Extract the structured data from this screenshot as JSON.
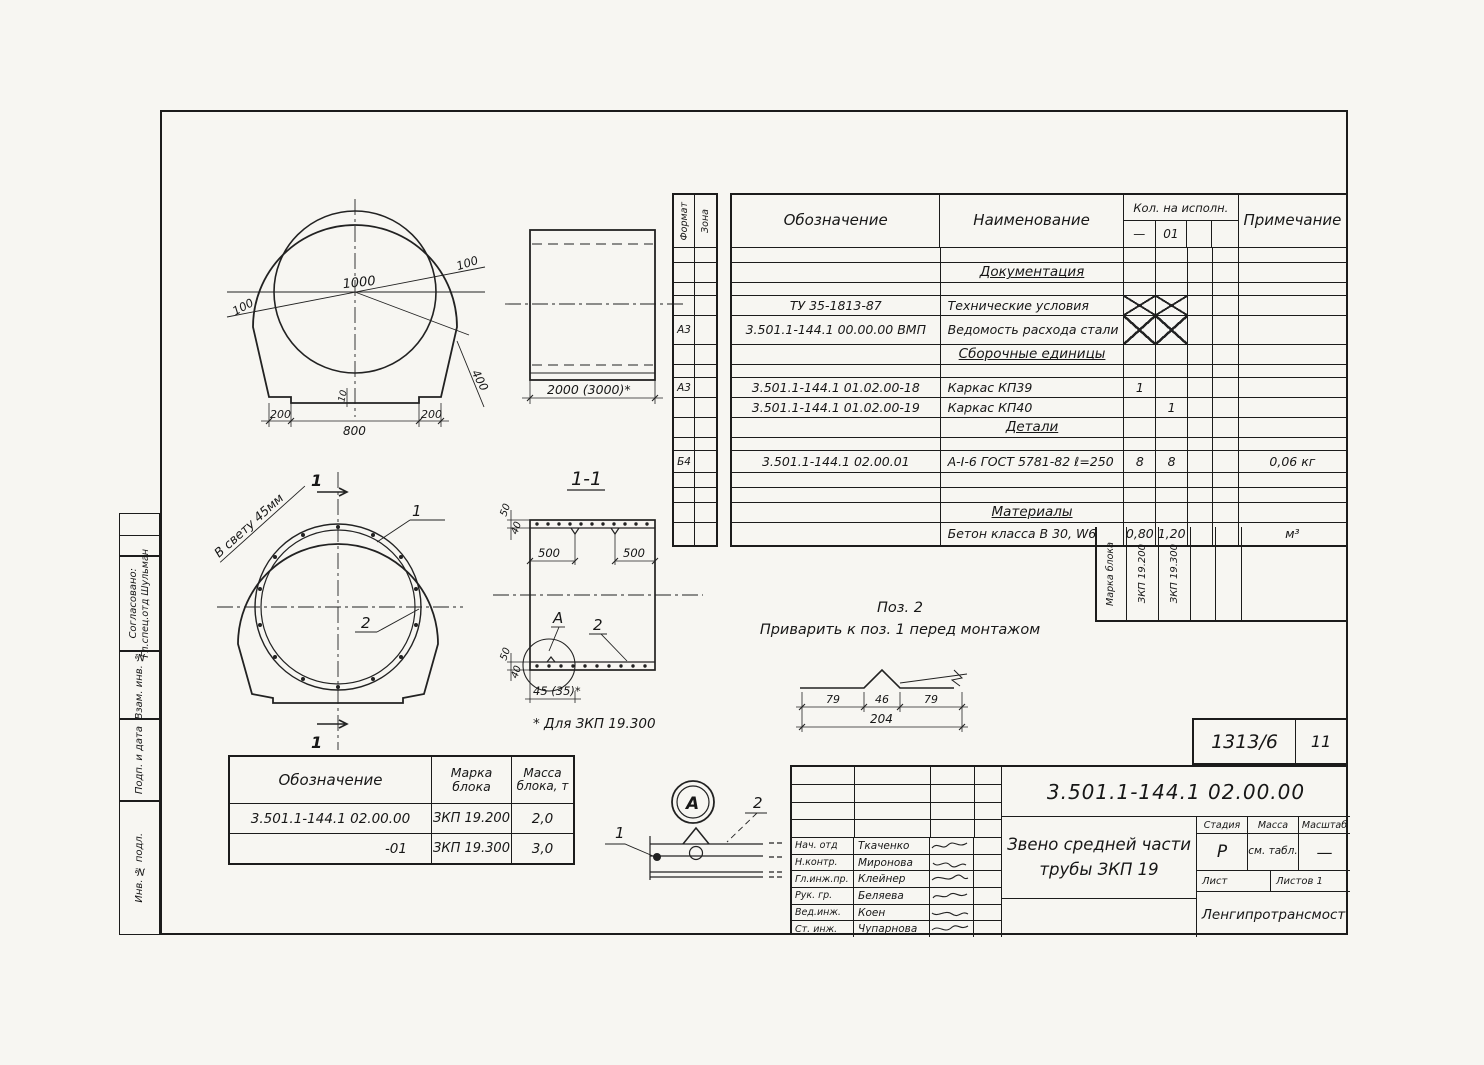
{
  "spec_table": {
    "col_format": "Формат",
    "col_zone": "Зона",
    "col_designation": "Обозначение",
    "col_name": "Наименование",
    "col_qty": "Кол. на исполн.",
    "col_qty1": "—",
    "col_qty2": "01",
    "col_note": "Примечание",
    "rows": [
      {
        "designation": "",
        "name": "",
        "qty1": "",
        "qty2": "",
        "note": ""
      },
      {
        "name": "Документация"
      },
      {},
      {
        "designation": "ТУ 35-1813-87",
        "name": "Технические условия"
      },
      {
        "format": "А3",
        "designation": "3.501.1-144.1 00.00.00 ВМП",
        "name": "Ведомость расхода стали"
      },
      {
        "name": "Сборочные единицы"
      },
      {},
      {
        "format": "А3",
        "designation": "3.501.1-144.1 01.02.00-18",
        "name": "Каркас КП39",
        "qty1": "1"
      },
      {
        "designation": "3.501.1-144.1 01.02.00-19",
        "name": "Каркас КП40",
        "qty2": "1"
      },
      {
        "name": "Детали"
      },
      {},
      {
        "format": "Б4",
        "designation": "3.501.1-144.1 02.00.01",
        "name": "А-I-6 ГОСТ 5781-82  ℓ=250",
        "qty1": "8",
        "qty2": "8",
        "note": "0,06 кг"
      },
      {},
      {},
      {
        "name": "Материалы"
      },
      {
        "name": "Бетон класса В 30, W6",
        "qty1": "0,80",
        "qty2": "1,20",
        "note": "м³"
      }
    ],
    "footer": {
      "mark_label": "Марка блока",
      "mark1": "ЗКП 19.200",
      "mark2": "ЗКП 19.300"
    }
  },
  "block_table": {
    "col_designation": "Обозначение",
    "col_mark": "Марка блока",
    "col_mass": "Масса блока, т",
    "rows": [
      {
        "designation": "3.501.1-144.1 02.00.00",
        "mark": "ЗКП 19.200",
        "mass": "2,0"
      },
      {
        "designation": "-01",
        "mark": "ЗКП 19.300",
        "mass": "3,0"
      }
    ]
  },
  "notes": {
    "pos2_title": "Поз. 2",
    "pos2_text": "Приварить к поз. 1 перед монтажом"
  },
  "drawings": {
    "front": {
      "d_inner": "1000",
      "d_wall_l": "100",
      "d_wall_r": "100",
      "d_diag": "400",
      "d_b1": "200",
      "d_b2": "800",
      "d_b3": "200",
      "d_small": "10"
    },
    "side": {
      "d_len": "2000 (3000)*"
    },
    "ring": {
      "clearance": "В свету 45мм",
      "pos1": "1",
      "pos2": "2",
      "cut_top": "1",
      "cut_bot": "1"
    },
    "section": {
      "title": "1-1",
      "d500a": "500",
      "d500b": "500",
      "d50t": "50",
      "d40t": "40",
      "d50b": "50",
      "d40b": "40",
      "d45": "45 (35)*",
      "posA": "А",
      "pos2": "2",
      "footnote": "* Для ЗКП 19.300"
    },
    "weld": {
      "d79a": "79",
      "d46": "46",
      "d79b": "79",
      "d204": "204"
    },
    "detail": {
      "label": "А",
      "pos1": "1",
      "pos2": "2"
    }
  },
  "stamp": {
    "number": "1313/6",
    "code": "11"
  },
  "title_block": {
    "doc_number": "3.501.1-144.1  02.00.00",
    "title1": "Звено средней части",
    "title2": "трубы ЗКП 19",
    "stage_label": "Стадия",
    "mass_label": "Масса",
    "scale_label": "Масштаб",
    "stage": "Р",
    "mass": "см. табл.",
    "scale": "—",
    "sheet_label": "Лист",
    "sheets_label": "Листов 1",
    "org": "Ленгипротрансмост",
    "staff": [
      {
        "role": "Нач. отд",
        "name": "Ткаченко"
      },
      {
        "role": "Н.контр.",
        "name": "Миронова"
      },
      {
        "role": "Гл.инж.пр.",
        "name": "Клейнер"
      },
      {
        "role": "Рук. гр.",
        "name": "Беляева"
      },
      {
        "role": "Вед.инж.",
        "name": "Коен"
      },
      {
        "role": "Ст. инж.",
        "name": "Чупарнова"
      }
    ]
  },
  "margin": {
    "agreed": "Согласовано:",
    "agreed_name": "Гл.спец.отд  Шульман",
    "vzam": "Взам. инв. №",
    "podp": "Подп. и дата",
    "inv": "Инв. № подл."
  }
}
